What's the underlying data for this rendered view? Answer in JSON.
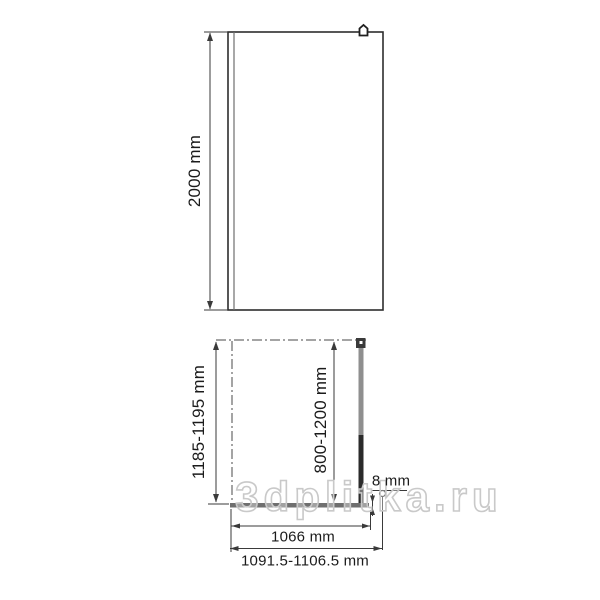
{
  "watermark": {
    "text": "3dplitka.ru"
  },
  "front_view": {
    "height_dim": "2000 mm"
  },
  "plan_view": {
    "depth_dim": "1185-1195 mm",
    "support_bar_dim": "800-1200 mm",
    "glass_thickness_dim": "8 mm",
    "glass_width_dim": "1066 mm",
    "overall_width_dim": "1091.5-1106.5 mm"
  },
  "colors": {
    "line": "#3a3a3a",
    "glass_fill": "#6f6f6f",
    "bar_light": "#8f8f8f",
    "bar_dark": "#2b2b2b",
    "bracket_fill": "#3a3a3a",
    "watermark_outline": "#c9c9c9"
  }
}
